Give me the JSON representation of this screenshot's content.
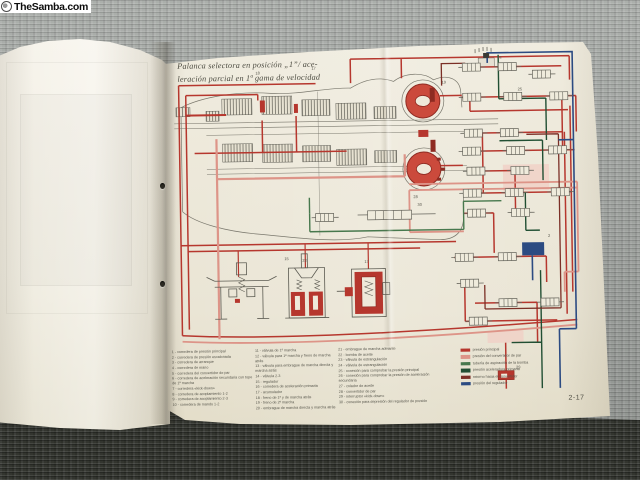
{
  "watermark": {
    "text": "TheSamba.com"
  },
  "page": {
    "title_line1": "Palanca selectora en posición „1”/ ace-",
    "title_line2": "leración parcial en 1ª gama de velocidad",
    "number": "2-17"
  },
  "diagram": {
    "part_labels": [
      "18",
      "17",
      "19",
      "28",
      "15",
      "22",
      "17",
      "30",
      "29",
      "24",
      "25",
      "2"
    ],
    "colors": {
      "main_pressure": "#b6372e",
      "converter_pressure": "#dd9488",
      "pump_suction": "#47784d",
      "primary_throttle": "#214f33",
      "converter_return": "#7b2f26",
      "governor_pressure": "#2c4b82"
    }
  },
  "legend": {
    "col1": [
      "1 - corredera de presión principal",
      "2 - corredera de presión escalonada",
      "3 - corredera de arranque",
      "4 - corredera de mano",
      "5 - corredera del convertidor de par",
      "6 - corredera de aceleración secundaria con tope de 1ª marcha",
      "7 - corredera «kick-down»",
      "8 - corredera de acoplamiento 1-2",
      "9 - corredera de acoplamiento 2-3",
      "10 - corredera de mando 1-2"
    ],
    "col2": [
      "11 - válvula de 1ª marcha",
      "12 - válvula para 1ª marcha y freno de marcha atrás",
      "13 - válvula para embrague de marcha directa y marcha atrás",
      "14 - válvula 2-3",
      "15 - regulador",
      "16 - corredera de aceleración primaria",
      "17 - acumulador",
      "18 - freno de 1ª y de marcha atrás",
      "19 - freno de 2ª marcha",
      "20 - embrague de marcha directa y marcha atrás"
    ],
    "col3": [
      "21 - embrague de marcha adelante",
      "22 - bomba de aceite",
      "23 - válvula de estrangulación",
      "24 - válvula de estrangulación",
      "25 - conexión para comprobar la presión principal",
      "26 - conexión para comprobar la presión de aceleración secundaria",
      "27 - colador de aceite",
      "28 - convertidor de par",
      "29 - interruptor «kick-down»",
      "30 - conexión para depresión del regulador de presión"
    ],
    "colors": [
      {
        "label": "presión principal",
        "color": "#b6372e"
      },
      {
        "label": "presión del convertidor de par",
        "color": "#dd9488"
      },
      {
        "label": "tubería de aspiración de la bomba",
        "color": "#47784d"
      },
      {
        "label": "presión aceleradora primaria",
        "color": "#214f33"
      },
      {
        "label": "retorno hacia el convertidor",
        "color": "#7b2f26"
      },
      {
        "label": "presión del regulador",
        "color": "#2c4b82"
      }
    ]
  }
}
